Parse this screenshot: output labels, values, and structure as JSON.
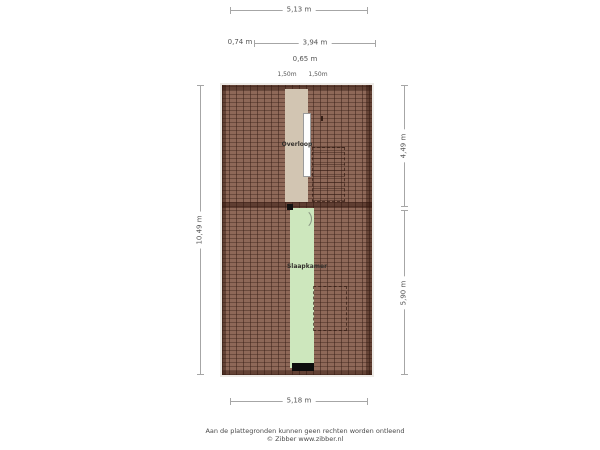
{
  "dimensions": {
    "top_total": "5,13 m",
    "top_seg_left": "0,74 m",
    "top_seg_right": "3,94 m",
    "top_offset": "0,65 m",
    "headroom_left": "1,50m",
    "headroom_right": "1,50m",
    "left_total": "10,49 m",
    "right_upper": "4,49 m",
    "right_lower": "5,90 m",
    "bottom_total": "5,18 m"
  },
  "rooms": {
    "landing": {
      "label": "Overloop"
    },
    "bedroom": {
      "label": "Slaapkamer"
    }
  },
  "footer": {
    "disclaimer": "Aan de plattegronden kunnen geen rechten worden ontleend",
    "credit": "© Zibber www.zibber.nl"
  },
  "colors": {
    "roof_hatch": "#8e6858",
    "roof_hatch_dark": "#4f2f24",
    "landing_floor": "#d2c5b2",
    "bedroom_floor": "#cde7bd",
    "dimension_line": "#a6a6a6",
    "text": "#555555"
  }
}
